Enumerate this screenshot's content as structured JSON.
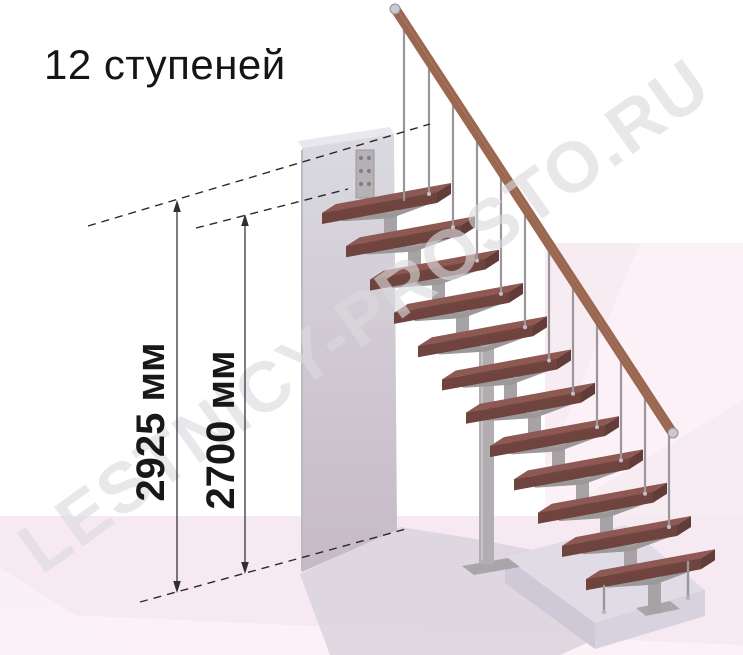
{
  "title": {
    "text": "12 ступеней"
  },
  "watermark": {
    "text": "LESTNICY-PROSTO.RU",
    "color": "#dbdbde"
  },
  "dimensions": {
    "total_height": {
      "value": 2925,
      "unit": "мм",
      "label": "2925 мм"
    },
    "floor_to_top_tread": {
      "value": 2700,
      "unit": "мм",
      "label": "2700 мм"
    }
  },
  "stairs": {
    "step_count": 12,
    "origin": [
      322,
      213
    ],
    "step_offset": [
      24,
      33.3
    ],
    "tread_long": [
      115,
      -21
    ],
    "tread_depth": [
      14,
      -9
    ],
    "tread_thickness": 11,
    "handrail": {
      "x1": 396,
      "y1": 10,
      "x2": 672,
      "y2": 432
    },
    "long_post_index": 4,
    "extra_baluster_x": 404,
    "bottom_posts": [
      [
        604,
        586,
        612
      ],
      [
        688,
        562,
        598
      ]
    ]
  },
  "colors": {
    "background": "#ffffff",
    "wall_pink": "#f8ecf3",
    "wall_pink_light": "#fcf3f8",
    "floor_pink": "#f6e9f1",
    "floor_shadow": "#d9d3dd",
    "column_top": "#dadae1",
    "column_bottom": "#c6bac7",
    "platform_top": "#e0dbe5",
    "tread_top": "#8d5952",
    "tread_front": "#6f433e",
    "tread_side": "#8f5c54",
    "tread_end": "#623c38",
    "metal": "#9c9799",
    "metal_light": "#b2adb0",
    "baluster": "#9a969b",
    "handrail": "#9c6750",
    "handrail_dark": "#7a4a39",
    "handrail_light": "#c59579",
    "dimension_line": "#2e2e34",
    "text": "#151515"
  }
}
